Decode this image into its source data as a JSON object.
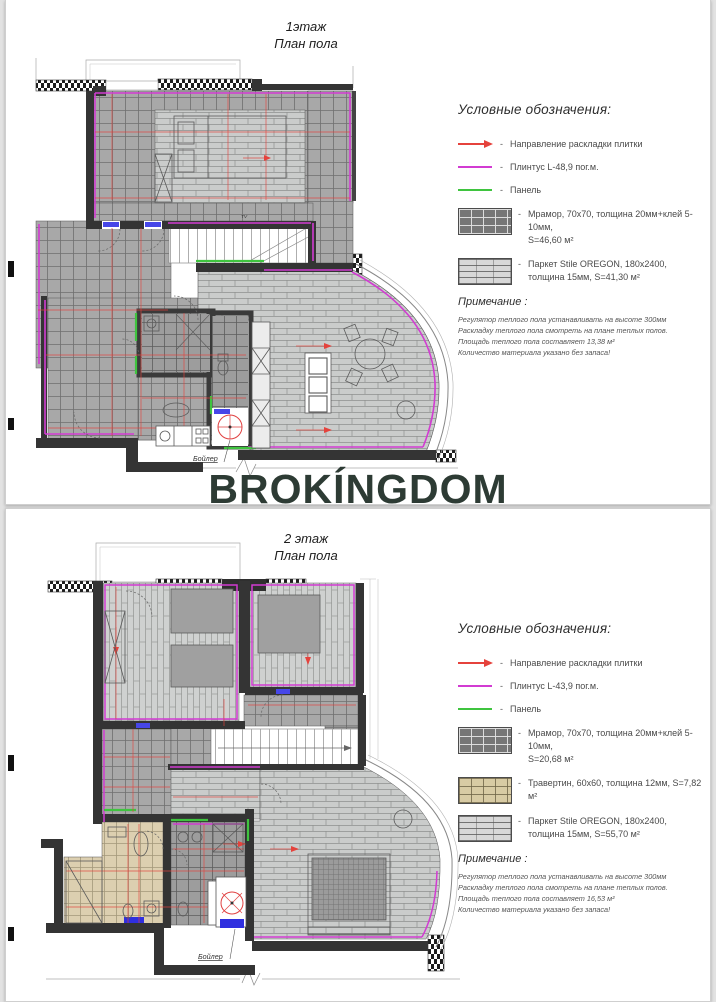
{
  "watermark": "BROKÍNGDOM",
  "ui": {
    "dash": "-"
  },
  "colors": {
    "plinth": "#d23bd2",
    "panel": "#3fc43f",
    "dimension": "#e5423c",
    "watermark": "#2d3b34"
  },
  "page1": {
    "title_line1": "1этаж",
    "title_line2": "План пола",
    "plan": {
      "boiler_label": "Бойлер",
      "tv_label": "TV"
    },
    "legend": {
      "heading": "Условные обозначения:",
      "items": [
        {
          "symbol": "tile-direction-arrow",
          "label": "Направление раскладки плитки"
        },
        {
          "symbol": "plinth-line",
          "label": "Плинтус L-48,9 пог.м."
        },
        {
          "symbol": "panel-line",
          "label": "Панель"
        }
      ],
      "materials": [
        {
          "swatch": "marble",
          "line1": "Мрамор, 70х70, толщина 20мм+клей 5-10мм,",
          "line2": "S=46,60 м²"
        },
        {
          "swatch": "parquet",
          "line1": "Паркет Stile OREGON, 180х2400,",
          "line2": "толщина 15мм, S=41,30 м²"
        }
      ],
      "note_heading": "Примечание :",
      "notes": [
        "Регулятор теплого пола устанавливать на высоте 300мм",
        "Раскладку теплого пола смотреть на плане теплых полов.",
        "Площадь теплого пола составляет 13,38 м²",
        "Количество материала указано без запаса!"
      ]
    }
  },
  "page2": {
    "title_line1": "2 этаж",
    "title_line2": "План пола",
    "plan": {
      "boiler_label": "Бойлер"
    },
    "legend": {
      "heading": "Условные обозначения:",
      "items": [
        {
          "symbol": "tile-direction-arrow",
          "label": "Направление раскладки плитки"
        },
        {
          "symbol": "plinth-line",
          "label": "Плинтус L-43,9 пог.м."
        },
        {
          "symbol": "panel-line",
          "label": "Панель"
        }
      ],
      "materials": [
        {
          "swatch": "marble",
          "line1": "Мрамор, 70х70, толщина 20мм+клей 5-10мм,",
          "line2": "S=20,68 м²"
        },
        {
          "swatch": "travertine",
          "line1": "Травертин, 60х60, толщина 12мм, S=7,82 м²",
          "line2": ""
        },
        {
          "swatch": "parquet",
          "line1": "Паркет Stile OREGON, 180х2400,",
          "line2": "толщина 15мм, S=55,70 м²"
        }
      ],
      "note_heading": "Примечание :",
      "notes": [
        "Регулятор теплого пола устанавливать на высоте 300мм",
        "Раскладку теплого пола смотреть на плане теплых полов.",
        "Площадь теплого пола составляет 16,53 м²",
        "Количество материала указано без запаса!"
      ]
    }
  }
}
